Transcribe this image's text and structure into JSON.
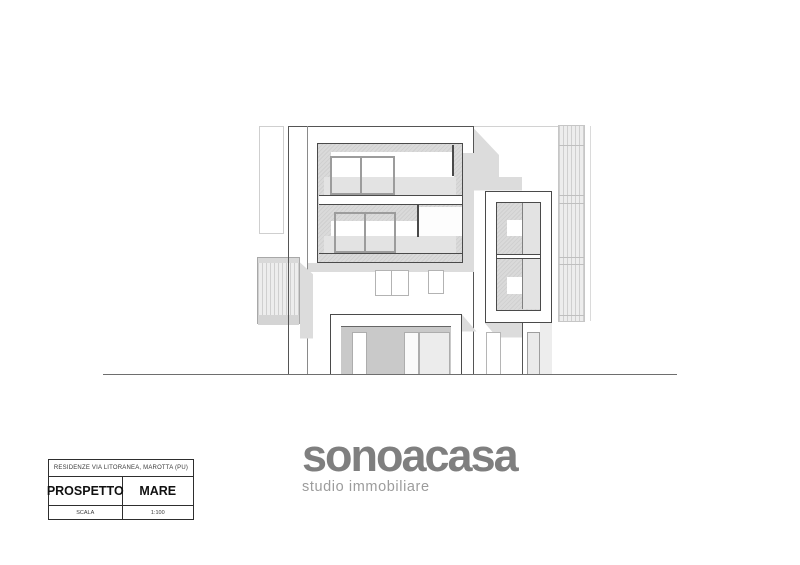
{
  "document": {
    "kind": "architectural elevation sheet",
    "background": "#ffffff"
  },
  "title_block": {
    "project_line": "RESIDENZE VIA LITORANEA, MAROTTA (PU)",
    "view_label": "PROSPETTO",
    "view_value": "MARE",
    "scale_label": "SCALA",
    "scale_value": "1:100"
  },
  "logo": {
    "brand": "sonoacasa",
    "tagline": "studio immobiliare",
    "brand_color": "#7f7f7f",
    "tagline_color": "#9c9c9c"
  },
  "drawing": {
    "subject": "sea-side elevation of residential building",
    "ink_color": "#4a4a4a",
    "shadow_color": "#dcdcdc",
    "panel_fill_color": "#d9d9d9",
    "recess_fill_color": "#c9c9c9",
    "faint_line_color": "#cfcfcf"
  }
}
